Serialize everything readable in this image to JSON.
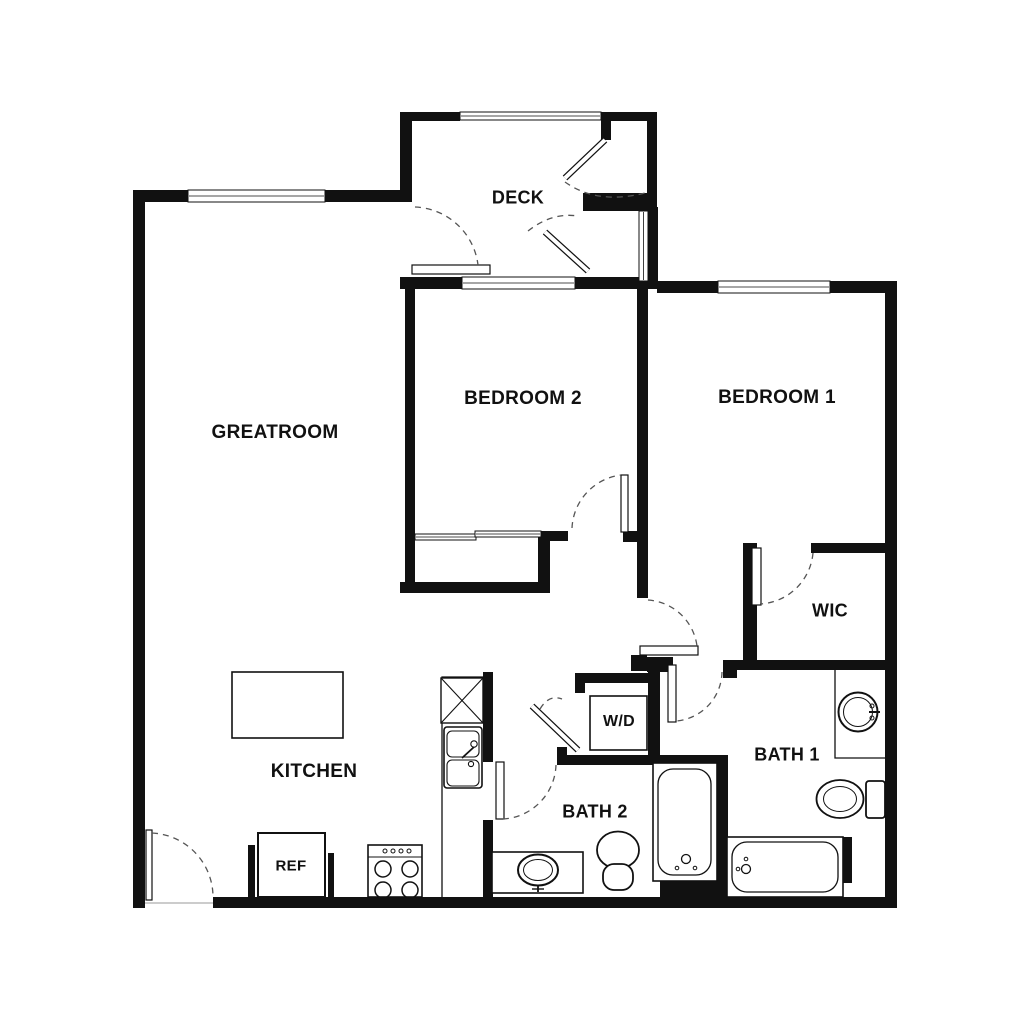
{
  "rooms": {
    "greatroom": {
      "label": "GREATROOM"
    },
    "deck": {
      "label": "DECK"
    },
    "bedroom2": {
      "label": "BEDROOM 2"
    },
    "bedroom1": {
      "label": "BEDROOM 1"
    },
    "wic": {
      "label": "WIC"
    },
    "bath1": {
      "label": "BATH 1"
    },
    "bath2": {
      "label": "BATH 2"
    },
    "kitchen": {
      "label": "KITCHEN"
    }
  },
  "appliances": {
    "washer_dryer": {
      "label": "W/D"
    },
    "refrigerator": {
      "label": "REF"
    }
  },
  "colors": {
    "background": "#ffffff",
    "wall": "#111111",
    "line": "#111111",
    "arc": "#555555",
    "shadow": "#bbbbbb"
  },
  "geometry": {
    "walls": [
      [
        133,
        190,
        12,
        718
      ],
      [
        133,
        190,
        55,
        12
      ],
      [
        325,
        190,
        87,
        12
      ],
      [
        400,
        112,
        12,
        78
      ],
      [
        400,
        112,
        60,
        9
      ],
      [
        601,
        112,
        56,
        9
      ],
      [
        601,
        112,
        10,
        28
      ],
      [
        647,
        112,
        10,
        99
      ],
      [
        583,
        193,
        74,
        18
      ],
      [
        648,
        207,
        10,
        76
      ],
      [
        400,
        277,
        62,
        12
      ],
      [
        575,
        277,
        82,
        12
      ],
      [
        657,
        281,
        61,
        12
      ],
      [
        830,
        281,
        67,
        12
      ],
      [
        885,
        281,
        12,
        627
      ],
      [
        213,
        897,
        684,
        11
      ],
      [
        405,
        277,
        10,
        316
      ],
      [
        540,
        531,
        28,
        10
      ],
      [
        623,
        531,
        15,
        11
      ],
      [
        538,
        531,
        12,
        62
      ],
      [
        400,
        582,
        150,
        11
      ],
      [
        637,
        283,
        11,
        315
      ],
      [
        743,
        543,
        14,
        127
      ],
      [
        811,
        543,
        86,
        10
      ],
      [
        723,
        660,
        174,
        10
      ],
      [
        723,
        660,
        14,
        18
      ],
      [
        631,
        655,
        16,
        16
      ],
      [
        647,
        657,
        26,
        15
      ],
      [
        648,
        672,
        12,
        93
      ],
      [
        575,
        673,
        85,
        10
      ],
      [
        575,
        673,
        10,
        20
      ],
      [
        557,
        747,
        10,
        18
      ],
      [
        557,
        755,
        171,
        10
      ],
      [
        483,
        672,
        10,
        90
      ],
      [
        483,
        820,
        10,
        77
      ],
      [
        717,
        765,
        11,
        132
      ],
      [
        843,
        837,
        9,
        46
      ],
      [
        248,
        845,
        7,
        52
      ],
      [
        328,
        853,
        6,
        44
      ],
      [
        660,
        878,
        57,
        20
      ]
    ],
    "windows": [
      {
        "x": 188,
        "y": 190,
        "w": 137,
        "h": 12,
        "o": "h"
      },
      {
        "x": 460,
        "y": 112,
        "w": 141,
        "h": 8,
        "o": "h"
      },
      {
        "x": 462,
        "y": 277,
        "w": 113,
        "h": 12,
        "o": "h"
      },
      {
        "x": 718,
        "y": 281,
        "w": 112,
        "h": 12,
        "o": "h"
      },
      {
        "x": 639,
        "y": 211,
        "w": 9,
        "h": 70,
        "o": "v"
      },
      {
        "x": 415,
        "y": 534,
        "w": 61,
        "h": 6,
        "o": "h"
      },
      {
        "x": 475,
        "y": 531,
        "w": 66,
        "h": 6,
        "o": "h"
      }
    ],
    "leaves": [
      [
        146,
        830,
        6,
        70
      ],
      [
        412,
        265,
        78,
        9
      ],
      [
        621,
        475,
        7,
        57
      ],
      [
        496,
        762,
        8,
        57
      ],
      [
        668,
        665,
        8,
        57
      ],
      [
        640,
        646,
        58,
        9
      ],
      [
        752,
        548,
        9,
        57
      ]
    ],
    "angled_leaves": [
      [
        605,
        140,
        565,
        178
      ],
      [
        545,
        232,
        588,
        271
      ],
      [
        532,
        706,
        578,
        750
      ]
    ],
    "arcs": [
      "M152,833 A64,64 0 0 1 213,897",
      "M415,207 A66,66 0 0 1 478,265",
      "M565,182 Q597,205 645,193",
      "M528,231 Q552,212 578,216",
      "M572,528 A56,56 0 0 1 621,475",
      "M648,600 A53,53 0 0 1 697,646",
      "M813,553 A56,56 0 0 1 760,604",
      "M722,672 A50,50 0 0 1 676,721",
      "M556,765 A56,56 0 0 1 503,819",
      "M540,709 Q549,694 562,699"
    ],
    "fixtures": [
      {
        "n": "kitchen-island",
        "parts": [
          {
            "t": "r",
            "x": 232,
            "y": 672,
            "w": 111,
            "h": 66,
            "sw": 1.6
          }
        ]
      },
      {
        "n": "refrigerator-box",
        "parts": [
          {
            "t": "r",
            "x": 258,
            "y": 833,
            "w": 67,
            "h": 64,
            "sw": 2
          }
        ]
      },
      {
        "n": "range-stove",
        "parts": [
          {
            "t": "r",
            "x": 368,
            "y": 845,
            "w": 54,
            "h": 52,
            "sw": 1.6
          },
          {
            "t": "l",
            "x1": 368,
            "y1": 857,
            "x2": 422,
            "y2": 857,
            "sw": 1
          },
          {
            "t": "c",
            "cx": 383,
            "cy": 869,
            "r": 8,
            "sw": 1.5
          },
          {
            "t": "c",
            "cx": 410,
            "cy": 869,
            "r": 8,
            "sw": 1.5
          },
          {
            "t": "c",
            "cx": 383,
            "cy": 890,
            "r": 8,
            "sw": 1.5
          },
          {
            "t": "c",
            "cx": 410,
            "cy": 890,
            "r": 8,
            "sw": 1.5
          },
          {
            "t": "c",
            "cx": 385,
            "cy": 851,
            "r": 2,
            "sw": 1
          },
          {
            "t": "c",
            "cx": 393,
            "cy": 851,
            "r": 2,
            "sw": 1
          },
          {
            "t": "c",
            "cx": 401,
            "cy": 851,
            "r": 2,
            "sw": 1
          },
          {
            "t": "c",
            "cx": 409,
            "cy": 851,
            "r": 2,
            "sw": 1
          }
        ]
      },
      {
        "n": "kitchen-counter",
        "parts": [
          {
            "t": "p",
            "d": "M442,897 L442,677 L483,677",
            "sw": 1.3
          }
        ]
      },
      {
        "n": "dishwasher-xbox",
        "parts": [
          {
            "t": "r",
            "x": 441,
            "y": 678,
            "w": 42,
            "h": 45,
            "sw": 1.4
          },
          {
            "t": "l",
            "x1": 441,
            "y1": 678,
            "x2": 483,
            "y2": 723,
            "sw": 1.1
          },
          {
            "t": "l",
            "x1": 483,
            "y1": 678,
            "x2": 441,
            "y2": 723,
            "sw": 1.1
          }
        ]
      },
      {
        "n": "kitchen-sink",
        "parts": [
          {
            "t": "r",
            "x": 444,
            "y": 727,
            "w": 38,
            "h": 61,
            "rx": 3,
            "sw": 1.6
          },
          {
            "t": "r",
            "x": 447,
            "y": 731,
            "w": 32,
            "h": 26,
            "rx": 5,
            "sw": 1.1
          },
          {
            "t": "r",
            "x": 447,
            "y": 760,
            "w": 32,
            "h": 26,
            "rx": 5,
            "sw": 1.1
          },
          {
            "t": "c",
            "cx": 474,
            "cy": 744,
            "r": 3.2,
            "sw": 1.1
          },
          {
            "t": "c",
            "cx": 471,
            "cy": 764,
            "r": 2.6,
            "sw": 1.1
          },
          {
            "t": "p",
            "d": "M462,758 L474,747",
            "sw": 1.8
          }
        ]
      },
      {
        "n": "bath2-vanity-sink",
        "parts": [
          {
            "t": "r",
            "x": 492,
            "y": 852,
            "w": 91,
            "h": 41,
            "sw": 1.6
          },
          {
            "t": "e",
            "cx": 538,
            "cy": 870,
            "rx": 20,
            "ry": 15.5,
            "sw": 2
          },
          {
            "t": "e",
            "cx": 538,
            "cy": 870,
            "rx": 14.5,
            "ry": 10.5,
            "sw": 1
          },
          {
            "t": "l",
            "x1": 538,
            "y1": 885,
            "x2": 538,
            "y2": 892,
            "sw": 1.8
          },
          {
            "t": "l",
            "x1": 532,
            "y1": 889,
            "x2": 544,
            "y2": 889,
            "sw": 1.4
          }
        ]
      },
      {
        "n": "bath2-toilet",
        "parts": [
          {
            "t": "e",
            "cx": 618,
            "cy": 850,
            "rx": 21,
            "ry": 18.5,
            "sw": 1.8
          },
          {
            "t": "r",
            "x": 603,
            "y": 864,
            "w": 30,
            "h": 26,
            "rx": 11,
            "sw": 1.8
          }
        ]
      },
      {
        "n": "bath2-tub",
        "parts": [
          {
            "t": "r",
            "x": 653,
            "y": 763,
            "w": 64,
            "h": 118,
            "sw": 1.6
          },
          {
            "t": "r",
            "x": 658,
            "y": 769,
            "w": 53,
            "h": 106,
            "rx": 15,
            "sw": 1.3
          },
          {
            "t": "c",
            "cx": 686,
            "cy": 859,
            "r": 4.5,
            "sw": 1.3
          },
          {
            "t": "c",
            "cx": 677,
            "cy": 868,
            "r": 1.8,
            "sw": 1
          },
          {
            "t": "c",
            "cx": 695,
            "cy": 868,
            "r": 1.8,
            "sw": 1
          }
        ]
      },
      {
        "n": "bath1-vanity-sink",
        "parts": [
          {
            "t": "p",
            "d": "M835,670 L835,758 L885,758",
            "sw": 1.3
          },
          {
            "t": "c",
            "cx": 858,
            "cy": 712,
            "r": 19.5,
            "sw": 2
          },
          {
            "t": "c",
            "cx": 858,
            "cy": 712,
            "r": 14.5,
            "sw": 1
          },
          {
            "t": "l",
            "x1": 869,
            "y1": 712,
            "x2": 880,
            "y2": 712,
            "sw": 2
          },
          {
            "t": "c",
            "cx": 872,
            "cy": 706,
            "r": 2,
            "sw": 1
          },
          {
            "t": "c",
            "cx": 872,
            "cy": 718,
            "r": 2,
            "sw": 1
          }
        ]
      },
      {
        "n": "bath1-toilet",
        "parts": [
          {
            "t": "r",
            "x": 866,
            "y": 781,
            "w": 19,
            "h": 37,
            "rx": 3,
            "sw": 1.8
          },
          {
            "t": "e",
            "cx": 840,
            "cy": 799,
            "rx": 23.5,
            "ry": 19,
            "sw": 1.8
          },
          {
            "t": "e",
            "cx": 840,
            "cy": 799,
            "rx": 16.5,
            "ry": 12.5,
            "sw": 1
          }
        ]
      },
      {
        "n": "bath1-tub",
        "parts": [
          {
            "t": "r",
            "x": 727,
            "y": 837,
            "w": 116,
            "h": 60,
            "sw": 1.6
          },
          {
            "t": "r",
            "x": 732,
            "y": 842,
            "w": 106,
            "h": 50,
            "rx": 15,
            "sw": 1.3
          },
          {
            "t": "c",
            "cx": 746,
            "cy": 869,
            "r": 4.5,
            "sw": 1.3
          },
          {
            "t": "c",
            "cx": 738,
            "cy": 869,
            "r": 1.8,
            "sw": 1
          },
          {
            "t": "c",
            "cx": 746,
            "cy": 859,
            "r": 1.8,
            "sw": 1
          }
        ]
      },
      {
        "n": "washer-dryer-box",
        "parts": [
          {
            "t": "r",
            "x": 590,
            "y": 696,
            "w": 57,
            "h": 54,
            "sw": 1.6
          }
        ]
      },
      {
        "n": "entry-threshold",
        "parts": [
          {
            "t": "sl",
            "x1": 145,
            "y1": 903,
            "x2": 213,
            "y2": 903,
            "sw": 1.5
          }
        ]
      }
    ]
  }
}
